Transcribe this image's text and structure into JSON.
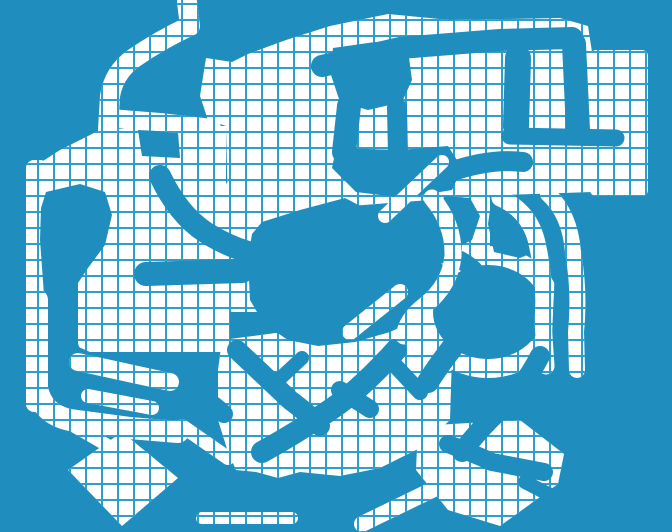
{
  "canvas": {
    "width": 672,
    "height": 532
  },
  "palette": {
    "background": "#1f8dbd",
    "grid_line": "#2f9ecb",
    "land": "#ffffff"
  },
  "grid": {
    "cell_size": 16,
    "line_width": 2,
    "offset_x": 7,
    "offset_y": 5
  },
  "map": {
    "base_shapes": [
      {
        "name": "top-slab",
        "type": "polygon",
        "points": "200,96 206,58 232,62 248,54 286,40 330,26 388,14 450,20 560,18 588,26 592,52 592,192 475,196 430,200 350,206 300,212 258,216 228,210 226,126 208,120"
      },
      {
        "name": "right-pocket-slab",
        "type": "rect",
        "x": 590,
        "y": 50,
        "w": 58,
        "h": 146,
        "rx": 6
      },
      {
        "name": "left-slab",
        "type": "polygon",
        "points": "26,172 60,150 96,132 140,126 226,126 226,240 26,240"
      },
      {
        "name": "left-column",
        "type": "rect",
        "x": 26,
        "y": 160,
        "w": 22,
        "h": 252,
        "rx": 8
      },
      {
        "name": "mid-left-slab",
        "type": "rect",
        "x": 78,
        "y": 228,
        "w": 152,
        "h": 124,
        "rx": 10
      },
      {
        "name": "center-left-slab",
        "type": "rect",
        "x": 224,
        "y": 180,
        "w": 78,
        "h": 132,
        "rx": 10
      },
      {
        "name": "bottom-center-slab",
        "type": "polygon",
        "points": "222,340 268,334 330,326 392,318 432,326 452,356 450,420 420,448 380,468 340,476 300,472 278,478 256,472 236,470 228,452 218,420 218,370"
      },
      {
        "name": "ring-base",
        "type": "ellipse",
        "cx": 488,
        "cy": 312,
        "rx": 74,
        "ry": 66
      },
      {
        "name": "ring-top-strip",
        "type": "rect",
        "x": 462,
        "y": 192,
        "w": 28,
        "h": 76,
        "rx": 8
      }
    ],
    "carve_shapes": [
      {
        "name": "top-band-corridor",
        "type": "path",
        "d": "M322,66 L400,48 L500,40 L572,38",
        "w": 22
      },
      {
        "name": "right-drop-corridor",
        "type": "path",
        "d": "M574,44 L578,130",
        "w": 24
      },
      {
        "name": "mid-drop-corridor",
        "type": "path",
        "d": "M518,58 L516,126",
        "w": 26
      },
      {
        "name": "cross-corridor",
        "type": "path",
        "d": "M510,136 L616,138",
        "w": 17
      },
      {
        "name": "top-blob",
        "type": "polygon",
        "points": "333,48 375,42 408,50 412,80 402,102 368,110 340,102 330,72"
      },
      {
        "name": "blob-leg-left",
        "type": "path",
        "d": "M349,106 L344,152",
        "w": 24
      },
      {
        "name": "blob-leg-right",
        "type": "path",
        "d": "M397,108 L398,155",
        "w": 20
      },
      {
        "name": "upper-center-blob",
        "type": "polygon",
        "points": "336,148 400,150 448,146 462,168 452,190 404,198 356,192 332,168"
      },
      {
        "name": "small-pocket",
        "type": "polygon",
        "points": "138,130 178,132 180,158 142,156"
      },
      {
        "name": "curve-corridor",
        "type": "path",
        "d": "M160,176 Q178,214 205,232 Q225,245 248,252",
        "w": 22
      },
      {
        "name": "left-band-corridor",
        "type": "path",
        "d": "M146,274 L242,271",
        "w": 24
      },
      {
        "name": "left-blob",
        "type": "polygon",
        "points": "46,192 80,184 105,192 112,215 105,245 88,268 70,295 55,308 44,295 40,240 41,208"
      },
      {
        "name": "left-leg-corridor",
        "type": "path",
        "d": "M57,303 L57,358",
        "w": 20
      },
      {
        "name": "sweep-corridor",
        "type": "path",
        "d": "M68,352 Q110,372 150,380 L190,392 Q210,400 224,414",
        "w": 18
      },
      {
        "name": "center-blob",
        "type": "polygon",
        "points": "262,222 300,210 345,198 372,212 392,230 430,252 446,268 440,300 420,318 390,332 355,342 318,346 288,340 264,324 250,300 248,258 252,234"
      },
      {
        "name": "neck-blob",
        "type": "polygon",
        "points": "444,196 470,198 480,216 472,240 456,248 444,234 441,210"
      },
      {
        "name": "neck-corridor",
        "type": "path",
        "d": "M442,254 Q462,258 474,270",
        "w": 18
      },
      {
        "name": "lake-circle",
        "type": "ellipse",
        "cx": 488,
        "cy": 312,
        "rx": 55,
        "ry": 47
      },
      {
        "name": "lake-tail",
        "type": "path",
        "d": "M452,348 Q438,366 428,382",
        "w": 22
      },
      {
        "name": "arc-gap-corridor",
        "type": "path",
        "d": "M549,207 Q563,242 561,292 Q559,332 558,366",
        "w": 14
      },
      {
        "name": "stub-corridor",
        "type": "path",
        "d": "M450,172 Q490,158 523,162",
        "w": 20
      },
      {
        "name": "ring-top-blob",
        "type": "polygon",
        "points": "492,196 525,202 534,226 539,250 520,258 494,252 488,224"
      },
      {
        "name": "diag-corridor-nw",
        "type": "path",
        "d": "M237,350 L290,400 Q310,415 320,426",
        "w": 20
      },
      {
        "name": "diag-corridor-ne",
        "type": "path",
        "d": "M396,350 Q360,390 330,410 Q298,432 262,452",
        "w": 22
      },
      {
        "name": "diag-stub",
        "type": "path",
        "d": "M340,390 Q356,400 370,409",
        "w": 18
      },
      {
        "name": "diag-cross",
        "type": "path",
        "d": "M302,358 L272,386",
        "w": 14
      },
      {
        "name": "diag-right",
        "type": "path",
        "d": "M390,360 L420,392",
        "w": 16
      },
      {
        "name": "bottom-band",
        "type": "polygon",
        "points": "56,487 120,470 162,467 210,471 233,479 254,492 280,492 300,479 345,481 394,477 440,469 470,461 500,469 530,479 558,474 584,480 584,532 56,532"
      }
    ],
    "overlay_shapes": [
      {
        "name": "entry-strip",
        "type": "path",
        "d": "M187,2 L190,26 Q160,40 134,58 Q114,72 110,96 L108,130",
        "w": 20
      },
      {
        "name": "entry-connector",
        "type": "path",
        "d": "M110,118 L160,122 L212,128",
        "w": 18
      },
      {
        "name": "j-bend-strip",
        "type": "path",
        "d": "M37,300 L37,388 Q42,414 70,420 L130,428 L178,432",
        "w": 22
      },
      {
        "name": "fringe-strip-a",
        "type": "path",
        "d": "M78,362 L170,382",
        "w": 18
      },
      {
        "name": "fringe-strip-b",
        "type": "path",
        "d": "M88,396 L152,408",
        "w": 14
      },
      {
        "name": "fringe-strip-c",
        "type": "path",
        "d": "M182,426 L228,458",
        "w": 14
      },
      {
        "name": "fringe-strip-d",
        "type": "path",
        "d": "M60,418 L112,448",
        "w": 13
      },
      {
        "name": "diamond-left",
        "type": "polygon",
        "points": "68,470 122,432 178,478 122,526"
      },
      {
        "name": "diamond-right",
        "type": "polygon",
        "points": "418,426 520,420 564,454 558,484 500,526 448,510 416,470"
      },
      {
        "name": "inner-arc-strip",
        "type": "path",
        "d": "M500,198 Q532,212 538,248 Q546,284 543,322 L546,366",
        "w": 17
      },
      {
        "name": "outer-arc-strip",
        "type": "path",
        "d": "M548,194 Q570,214 573,252 Q580,292 576,332 L577,370",
        "w": 16
      },
      {
        "name": "center-arc-strip",
        "type": "path",
        "d": "M432,198 Q454,224 453,256 Q450,286 424,306 Q407,319 404,336",
        "w": 17
      },
      {
        "name": "diag-strip-upper",
        "type": "path",
        "d": "M385,216 L442,162",
        "w": 14
      },
      {
        "name": "diag-strip-center",
        "type": "path",
        "d": "M350,332 L400,292",
        "w": 16
      },
      {
        "name": "bottom-strip",
        "type": "path",
        "d": "M202,518 L292,518",
        "w": 12
      },
      {
        "name": "bottom-diag-strip",
        "type": "path",
        "d": "M362,524 L432,490",
        "w": 16
      }
    ],
    "carve_top_shapes": [
      {
        "name": "t-arm-corridor",
        "type": "path",
        "d": "M448,444 Q470,452 492,462 L544,472",
        "w": 18
      },
      {
        "name": "ring-exit-corridor",
        "type": "path",
        "d": "M540,356 Q522,390 500,410 Q480,428 462,452",
        "w": 20
      },
      {
        "name": "diamond-notch",
        "type": "path",
        "d": "M525,482 L556,498",
        "w": 14
      }
    ]
  }
}
